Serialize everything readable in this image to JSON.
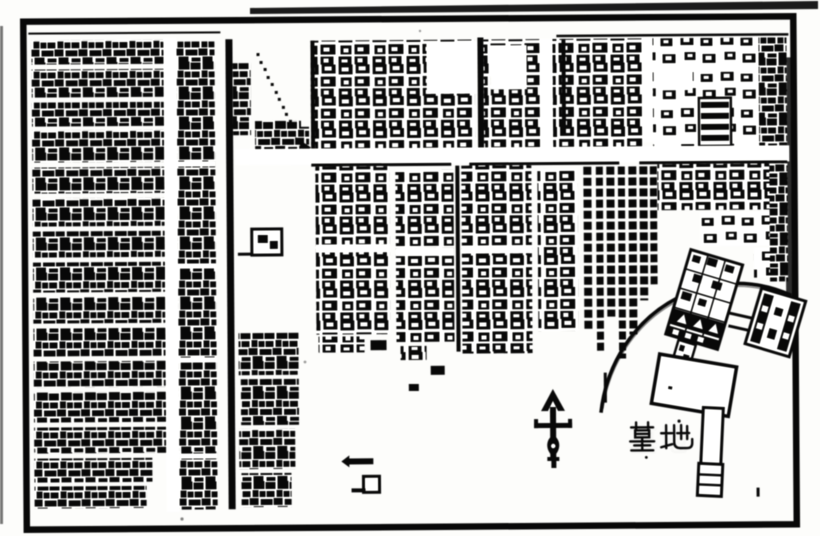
{
  "map": {
    "paper_color": "#fdfdfb",
    "ink_color": "#151515",
    "labels": {
      "cemetery": "墓地"
    },
    "symbols": {
      "north_arrow": "↑"
    }
  }
}
